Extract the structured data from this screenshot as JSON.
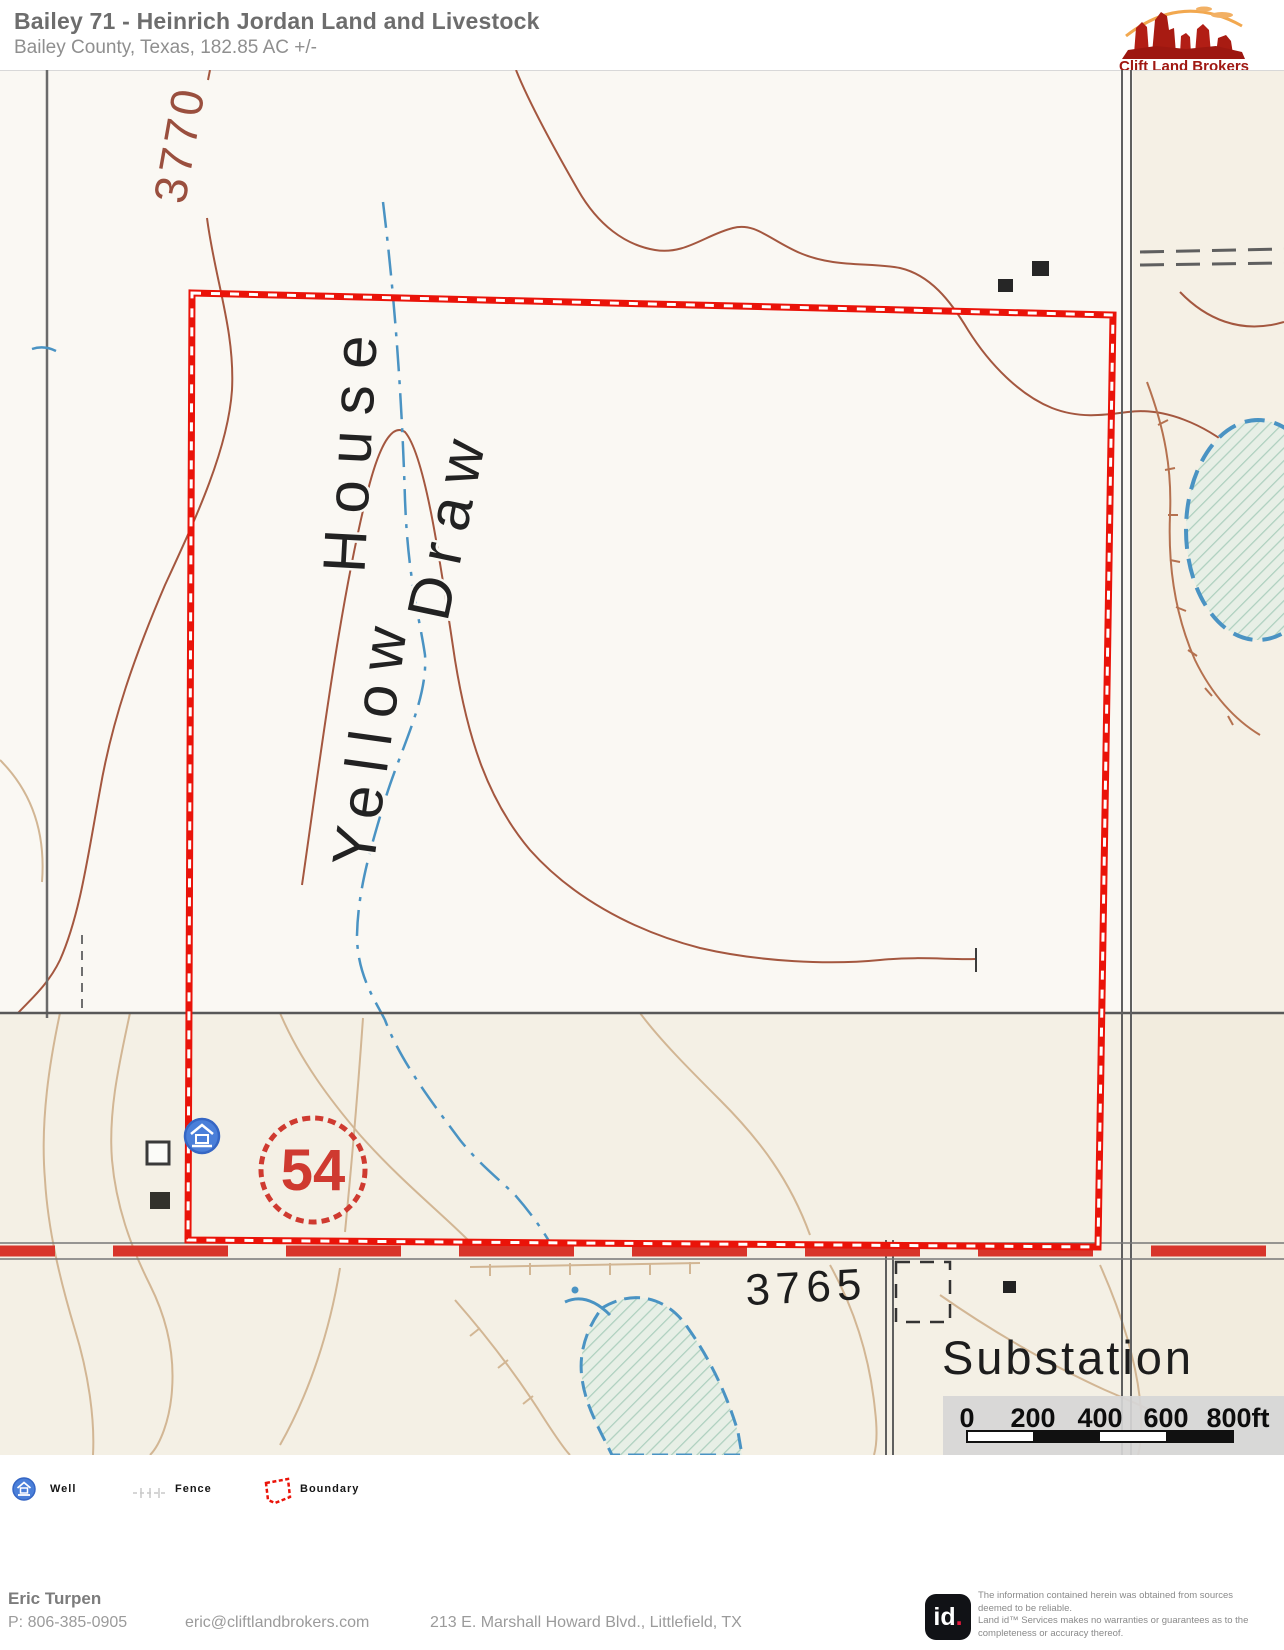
{
  "header": {
    "title": "Bailey 71 - Heinrich Jordan Land and Livestock",
    "subtitle": "Bailey County, Texas, 182.85 AC +/-",
    "logo_text": "Clift Land Brokers"
  },
  "map": {
    "labels": {
      "contour_3770": "3770",
      "yellow": "Yellow",
      "house": "House",
      "draw": "Draw",
      "shield": "54",
      "spot_elev": "3765",
      "substation": "Substation"
    },
    "scale": {
      "ticks": [
        "0",
        "200",
        "400",
        "600",
        "800ft"
      ]
    },
    "colors": {
      "boundary_red": "#ea1309",
      "highway_red": "#d8352b",
      "shield_red": "#cf3a30",
      "contour_brown": "#a4573f",
      "contour_tan": "#d2b694",
      "stream_blue": "#4a93c3",
      "road_gray": "#5f5f5f",
      "topo_black": "#1e1e1e",
      "well_blue": "#4a7fd9"
    }
  },
  "legend": {
    "items": [
      {
        "icon": "well-icon",
        "label": "Well"
      },
      {
        "icon": "fence-icon",
        "label": "Fence"
      },
      {
        "icon": "boundary-icon",
        "label": "Boundary"
      }
    ]
  },
  "footer": {
    "agent_name": "Eric Turpen",
    "phone": "P: 806-385-0905",
    "email": "eric@cliftlandbrokers.com",
    "address": "213 E. Marshall Howard Blvd., Littlefield, TX",
    "id_text": "id",
    "id_dot": ".",
    "disclaimer": [
      "The information contained herein was obtained from sources",
      "deemed to be reliable.",
      "Land id™ Services makes no warranties or guarantees as to the",
      "completeness or accuracy thereof."
    ]
  }
}
